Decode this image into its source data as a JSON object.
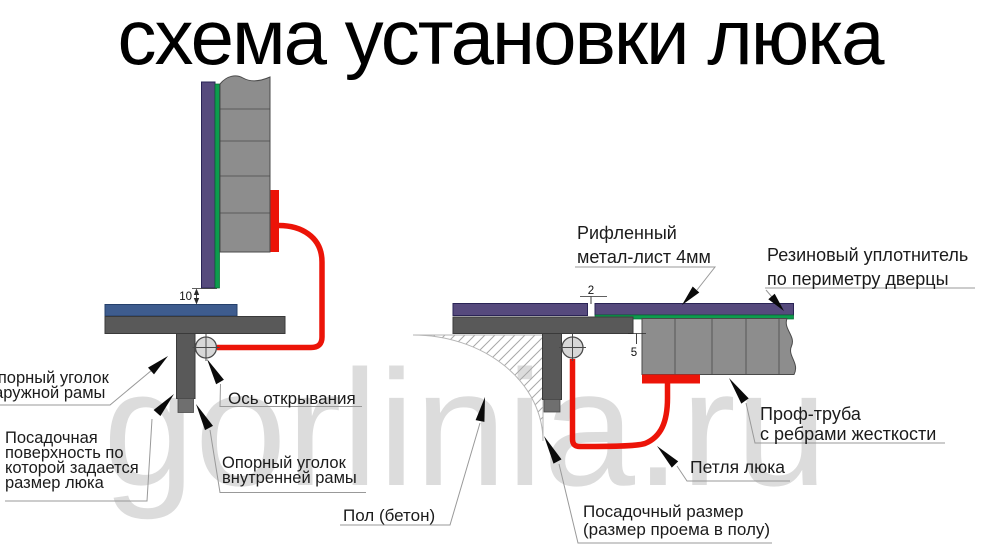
{
  "title": "схема установки люка",
  "watermark": "gorlinia.ru",
  "dimensions": {
    "door_bottom_gap": "10",
    "sheet_overhang": "2",
    "frame_gap": "5"
  },
  "left_view": {
    "outer_angle": [
      "Опорный уголок",
      "наружной рамы"
    ],
    "seating_surface": [
      "Посадочная",
      "поверхность по",
      "которой задается",
      "размер люка"
    ],
    "opening_axis": "Ось открывания",
    "inner_angle": [
      "Опорный уголок",
      "внутренней рамы"
    ]
  },
  "right_view": {
    "sheet": [
      "Рифленный",
      "метал-лист 4мм"
    ],
    "seal": [
      "Резиновый уплотнитель",
      "по периметру дверцы"
    ],
    "tube": [
      "Проф-труба",
      "с ребрами жесткости"
    ],
    "hinge": "Петля люка",
    "floor": "Пол (бетон)",
    "opening_size": [
      "Посадочный размер",
      "(размер проема в полу)"
    ]
  },
  "palette": {
    "purple_sheet": "#564a7d",
    "green_seal": "#0d9b4e",
    "red_hinge": "#ec1408",
    "blue_lid": "#3e5c8e",
    "frame_dark_gray": "#595959",
    "tube_gray": "#8d8d8d",
    "watermark_gray": "#dcdcdc"
  }
}
